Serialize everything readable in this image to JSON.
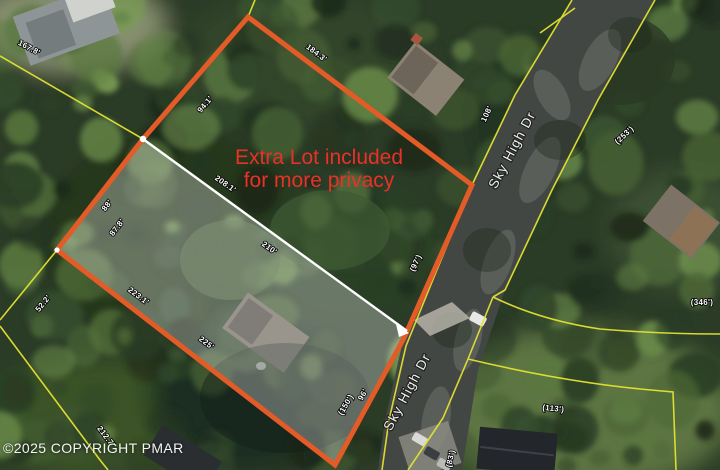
{
  "map": {
    "copyright": "©2025 COPYRIGHT PMAR",
    "annotation": {
      "line1": "Extra Lot included",
      "line2": "for more privacy"
    },
    "road_name": "Sky High Dr",
    "road_labels": [
      {
        "text": "Sky High Dr",
        "x": 516,
        "y": 152,
        "rot": -62
      },
      {
        "text": "Sky High Dr",
        "x": 411,
        "y": 394,
        "rot": -62
      }
    ],
    "dimension_labels": [
      {
        "text": "167.8'",
        "x": 28,
        "y": 50,
        "rot": 28
      },
      {
        "text": "184.3'",
        "x": 315,
        "y": 55,
        "rot": 37
      },
      {
        "text": "94.1'",
        "x": 207,
        "y": 106,
        "rot": -50
      },
      {
        "text": "108'",
        "x": 489,
        "y": 115,
        "rot": -65
      },
      {
        "text": "(253')",
        "x": 626,
        "y": 137,
        "rot": -43
      },
      {
        "text": "208.1'",
        "x": 224,
        "y": 186,
        "rot": 35
      },
      {
        "text": "210'",
        "x": 268,
        "y": 250,
        "rot": 35
      },
      {
        "text": "88'",
        "x": 109,
        "y": 207,
        "rot": -52
      },
      {
        "text": "87.8'",
        "x": 119,
        "y": 229,
        "rot": -52
      },
      {
        "text": "52.2'",
        "x": 45,
        "y": 305,
        "rot": -51
      },
      {
        "text": "223.1'",
        "x": 137,
        "y": 298,
        "rot": 37
      },
      {
        "text": "225'",
        "x": 205,
        "y": 345,
        "rot": 37
      },
      {
        "text": "(97')",
        "x": 418,
        "y": 264,
        "rot": -65
      },
      {
        "text": "(150')",
        "x": 348,
        "y": 406,
        "rot": -60
      },
      {
        "text": "96'",
        "x": 365,
        "y": 396,
        "rot": -60
      },
      {
        "text": "(113')",
        "x": 553,
        "y": 411,
        "rot": 6
      },
      {
        "text": "(346')",
        "x": 702,
        "y": 305,
        "rot": 0
      },
      {
        "text": "212.7'",
        "x": 104,
        "y": 438,
        "rot": 53
      },
      {
        "text": "(83')",
        "x": 453,
        "y": 459,
        "rot": -78
      }
    ],
    "colors": {
      "lot_outline": "#e35b27",
      "parcel_line": "#e3e233",
      "highlight_line": "#ffffff",
      "annotation_text": "#e93127",
      "label_text": "#ffffff",
      "road_surface": "#434743"
    }
  }
}
